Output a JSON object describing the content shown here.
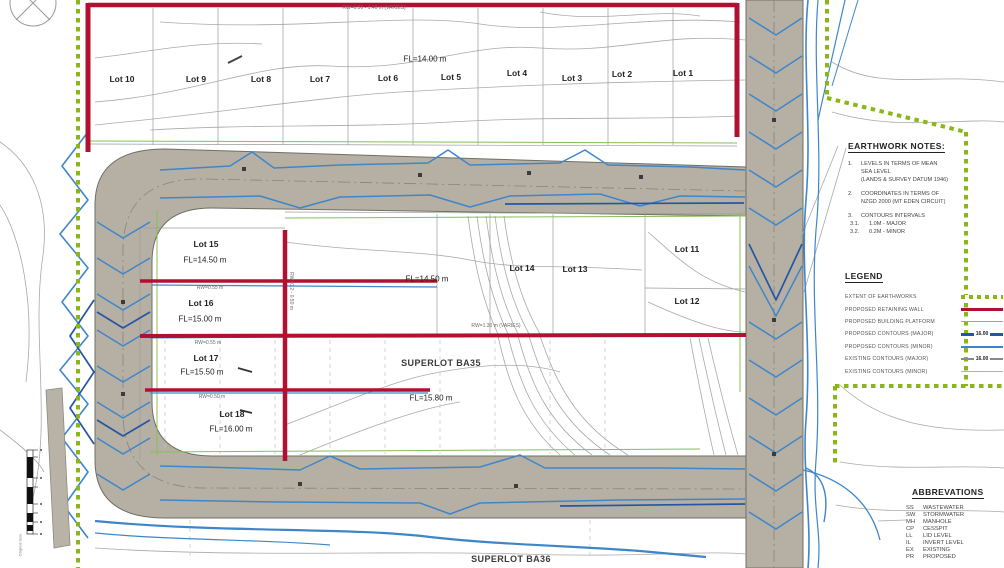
{
  "colors": {
    "road": "#b6b0a4",
    "retaining_wall": "#b01130",
    "earthworks_boundary": "#8ab717",
    "building_platform": "#84bf5a",
    "proposed_contour_major": "#2456a4",
    "proposed_contour_minor": "#3f86c9",
    "existing_contour": "#a9a9a9"
  },
  "plan": {
    "labels": {
      "rw_top": "RW=0.50 - 1.40 m (VARIES)",
      "fl_top": "FL=14.00 m",
      "lots_top": [
        "Lot 10",
        "Lot 9",
        "Lot 8",
        "Lot 7",
        "Lot 6",
        "Lot 5",
        "Lot 4",
        "Lot 3",
        "Lot 2",
        "Lot 1"
      ],
      "lot15": "Lot 15",
      "lot15_fl": "FL=14.50 m",
      "rw_055a": "RW=0.55 m",
      "lot16": "Lot 16",
      "lot16_fl": "FL=15.00 m",
      "rw_055b": "RW=0.55 m",
      "lot17": "Lot 17",
      "lot17_fl": "FL=15.50 m",
      "rw_050": "RW=0.50 m",
      "lot18": "Lot 18",
      "lot18_fl": "FL=16.00 m",
      "fl_mid": "FL=14.50 m",
      "lot14": "Lot 14",
      "lot13": "Lot 13",
      "lot11": "Lot 11",
      "lot12": "Lot 12",
      "rw_mid": "RW=1.30 m (VARIES)",
      "rw_vert": "RW=0.2 - 0.50 m",
      "superlot_ba35": "SUPERLOT BA35",
      "superlot_ba35_fl": "FL=15.80 m",
      "superlot_ba36": "SUPERLOT BA36",
      "scale_note": "Original Size"
    }
  },
  "earthwork_notes": {
    "title": "EARTHWORK NOTES:",
    "rows": [
      {
        "num": "1.",
        "text": "LEVELS IN TERMS OF MEAN"
      },
      {
        "num": "",
        "text": "SEA LEVEL"
      },
      {
        "num": "",
        "text": "(LANDS & SURVEY DATUM 1946)"
      },
      {
        "num": "2.",
        "text": "COORDINATES IN TERMS OF"
      },
      {
        "num": "",
        "text": "NZGD 2000 (MT EDEN CIRCUIT)"
      },
      {
        "num": "3.",
        "text": "CONTOURS INTERVALS"
      },
      {
        "num": "3.1.",
        "text": "1.0M - MAJOR"
      },
      {
        "num": "3.2.",
        "text": "0.2M - MINOR"
      }
    ]
  },
  "legend": {
    "title": "LEGEND",
    "items": [
      {
        "label": "EXTENT OF EARTHWORKS"
      },
      {
        "label": "PROPOSED RETAINING WALL"
      },
      {
        "label": "PROPOSED BUILDING PLATFORM"
      },
      {
        "label": "PROPOSED CONTOURS (MAJOR)",
        "value": "16.00"
      },
      {
        "label": "PROPOSED CONTOURS (MINOR)"
      },
      {
        "label": "EXISTING CONTOURS (MAJOR)",
        "value": "16.00"
      },
      {
        "label": "EXISTING CONTOURS (MINOR)"
      }
    ]
  },
  "abbreviations": {
    "title": "ABBREVATIONS",
    "rows": [
      {
        "abbr": "SS",
        "term": "WASTEWATER"
      },
      {
        "abbr": "SW",
        "term": "STORMWATER"
      },
      {
        "abbr": "MH",
        "term": "MANHOLE"
      },
      {
        "abbr": "CP",
        "term": "CESSPIT"
      },
      {
        "abbr": "LL",
        "term": "LID LEVEL"
      },
      {
        "abbr": "IL",
        "term": "INVERT LEVEL"
      },
      {
        "abbr": "EX",
        "term": "EXISTING"
      },
      {
        "abbr": "PR",
        "term": "PROPOSED"
      }
    ]
  }
}
